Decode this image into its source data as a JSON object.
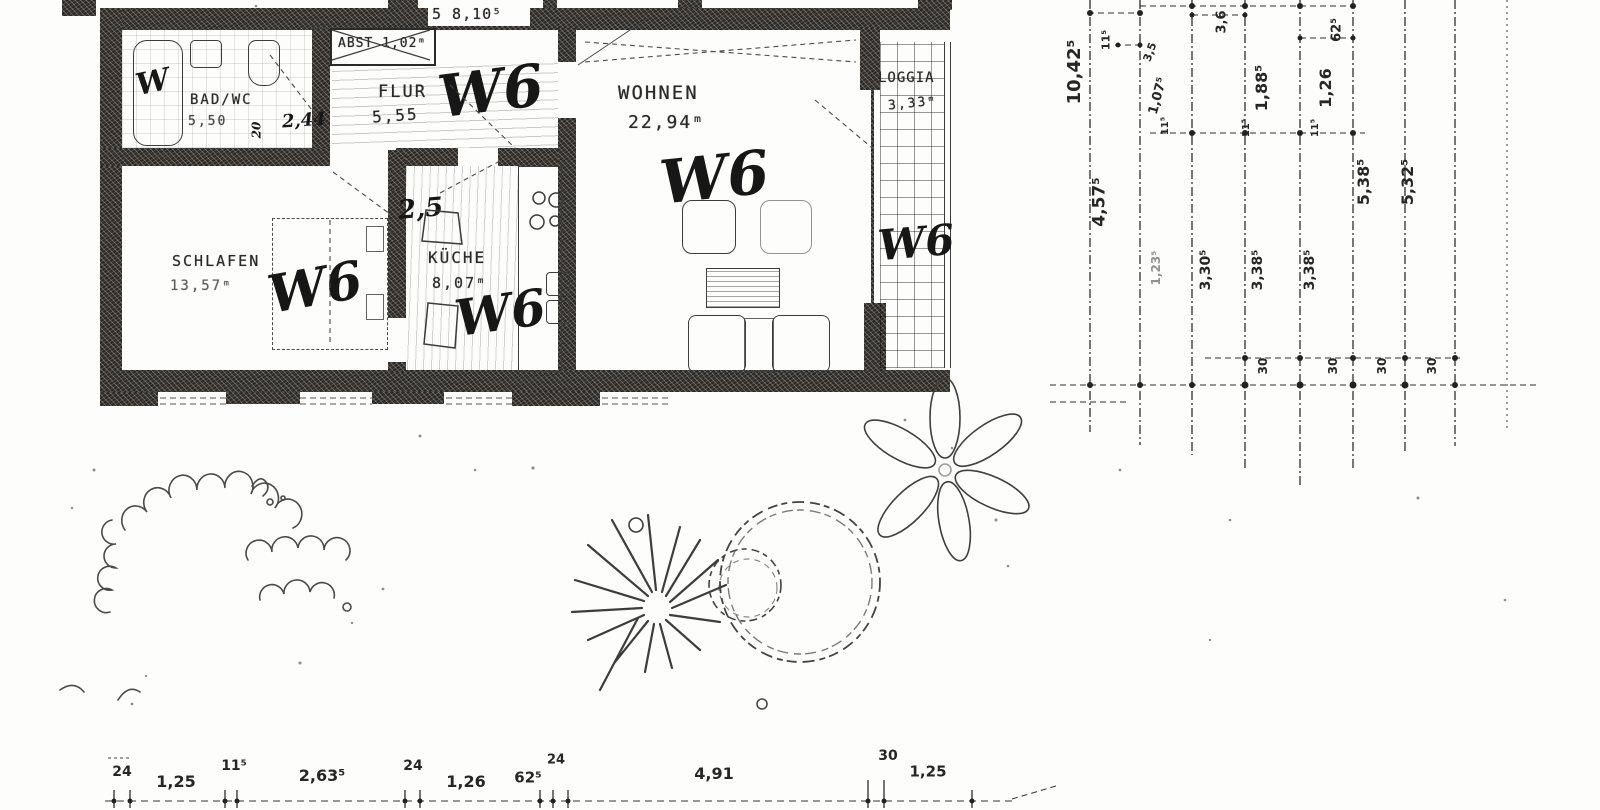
{
  "plan": {
    "top_dim": "5 8,10⁵",
    "rooms": [
      {
        "id": "badwc",
        "name": "BAD/WC",
        "area": "5,50"
      },
      {
        "id": "abst",
        "name": "ABST 1,02ᵐ",
        "area": "1,02ᵐ"
      },
      {
        "id": "flur",
        "name": "FLUR",
        "area": "5,55"
      },
      {
        "id": "wohnen",
        "name": "WOHNEN",
        "area": "22,94ᵐ"
      },
      {
        "id": "loggia",
        "name": "LOGGIA",
        "area": "3,33ᵐ"
      },
      {
        "id": "schlafen",
        "name": "SCHLAFEN",
        "area": "13,57ᵐ"
      },
      {
        "id": "kueche",
        "name": "KÜCHE",
        "area": "8,07ᵐ"
      }
    ],
    "handwritten": {
      "w6": "W6",
      "w_bad": "W",
      "note_kueche": "2,5",
      "note_bad": "2,44",
      "note_bad_vert": "20"
    }
  },
  "dims_right": {
    "labels": [
      "10,42⁵",
      "11⁵",
      "3,5",
      "1,07⁵",
      "11⁵",
      "3,6",
      "1,88⁵",
      "11⁵",
      "62⁵",
      "1,26",
      "11⁵",
      "4,57⁵",
      "1,23⁵",
      "3,30⁵",
      "3,38⁵",
      "3,38⁵",
      "5,38⁵",
      "5,32⁵",
      "30",
      "30",
      "30",
      "30"
    ]
  },
  "dims_bottom": {
    "labels": [
      "24",
      "1,25",
      "11⁵",
      "2,63⁵",
      "24",
      "1,26",
      "62⁵",
      "24",
      "4,91",
      "30",
      "1,25"
    ]
  }
}
